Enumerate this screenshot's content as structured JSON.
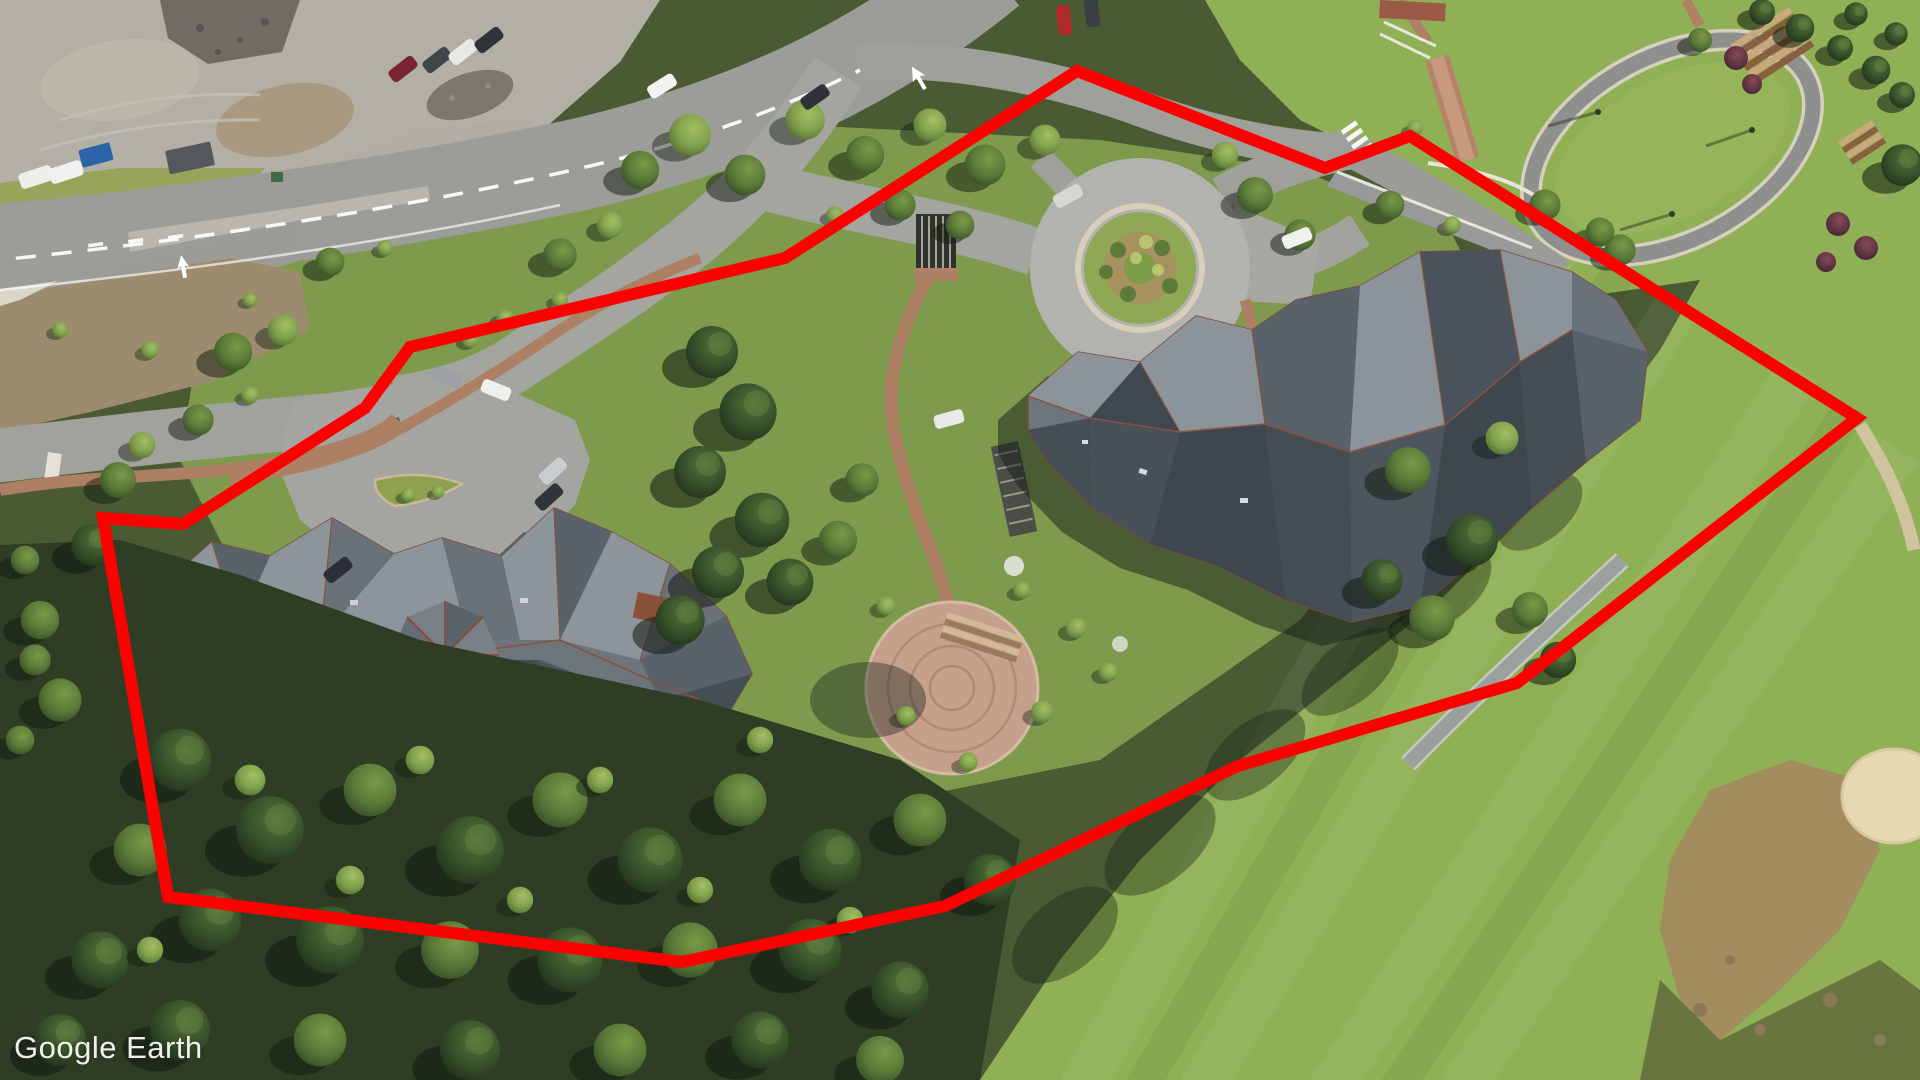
{
  "watermark": {
    "text": "Google Earth"
  },
  "overlay": {
    "parcel_outline": {
      "points": "1077,71 1325,168 1410,136 1857,418 1517,683 1238,766 945,906 682,962 168,897 103,518 183,524 365,408 410,347 785,258",
      "stroke_color": "#ff0000",
      "stroke_width": 12
    }
  }
}
